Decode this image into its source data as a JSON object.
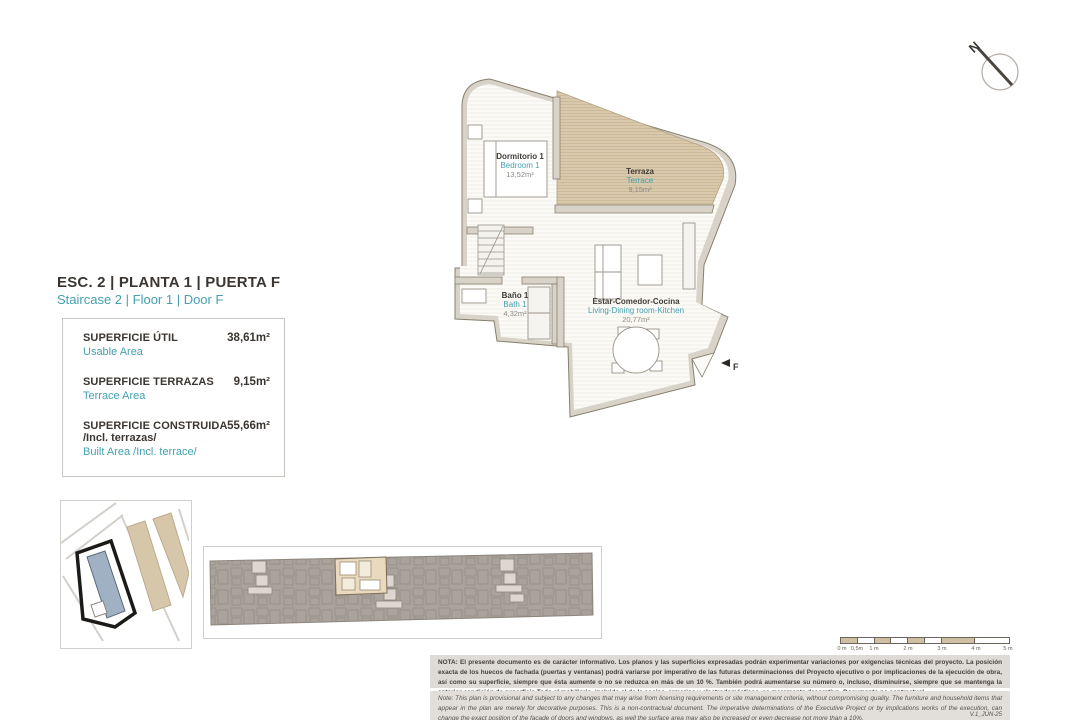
{
  "document": {
    "title_es": "ESC. 2 | PLANTA 1 | PUERTA F",
    "title_en": "Staircase 2 | Floor 1 | Door F",
    "version": "V.1_JUN-25"
  },
  "areas_table": {
    "rows": [
      {
        "label_es": "SUPERFICIE ÚTIL",
        "label_en": "Usable Area",
        "value": "38,61m²"
      },
      {
        "label_es": "SUPERFICIE TERRAZAS",
        "label_en": "Terrace Area",
        "value": "9,15m²"
      },
      {
        "label_es": "SUPERFICIE CONSTRUIDA",
        "label_es2": "/Incl. terrazas/",
        "label_en": "Built Area /Incl. terrace/",
        "value": "55,66m²"
      }
    ]
  },
  "floor_plan": {
    "north_label": "N",
    "entry_door_label": "F",
    "rooms": [
      {
        "name_es": "Dormitorio 1",
        "name_en": "Bedroom 1",
        "area": "13,52m²"
      },
      {
        "name_es": "Terraza",
        "name_en": "Terrace",
        "area": "9,15m²"
      },
      {
        "name_es": "Baño 1",
        "name_en": "Bath 1",
        "area": "4,32m²"
      },
      {
        "name_es": "Estar-Comedor-Cocina",
        "name_en": "Living-Dining room-Kitchen",
        "area": "20,77m²"
      }
    ]
  },
  "scale_bar": {
    "tick_labels": [
      "0 m",
      "0,5m",
      "1 m",
      "2 m",
      "3 m",
      "4 m",
      "5 m"
    ]
  },
  "notes": {
    "es": "NOTA: El presente documento es de carácter informativo. Los planos y las superficies expresadas podrán experimentar variaciones por exigencias técnicas del proyecto. La posición exacta de los huecos de fachada (puertas y ventanas) podrá variarse por imperativo de las futuras determinaciones del Proyecto ejecutivo o por implicaciones de la ejecución de obra, así como su superficie, siempre que ésta aumente o no se reduzca en más de un 10 %. También podrá aumentarse su número o, incluso, disminuirse, siempre que se mantenga la anterior condición de superficie.Todo el mobiliario, incluido el de la cocina, armarios y electrodomésticos, es meramente decorativo. Documento no contractual.",
    "en": "Note: This plan is provisional and subject to any changes that may arise from licensing requirements or site management criteria, without compromising quality. The furniture and household items that appear in the plan are merely for decorative purposes. This is a non-contractual document. The imperative determinations of the Executive Project or by implications works of the execution, can change the exact position of the facade of doors and windows, as well the surface area may also be increased or even decrease not more than a 10%."
  },
  "colors": {
    "accent_teal": "#46a0b0",
    "text_dark": "#3b3631",
    "terrace_tan": "#d8c8ab",
    "wall_gray": "#d8d2c8",
    "site_building_blue": "#9fb1c2",
    "strip_gray": "#a9a39c",
    "note_bg": "#dedad6"
  }
}
